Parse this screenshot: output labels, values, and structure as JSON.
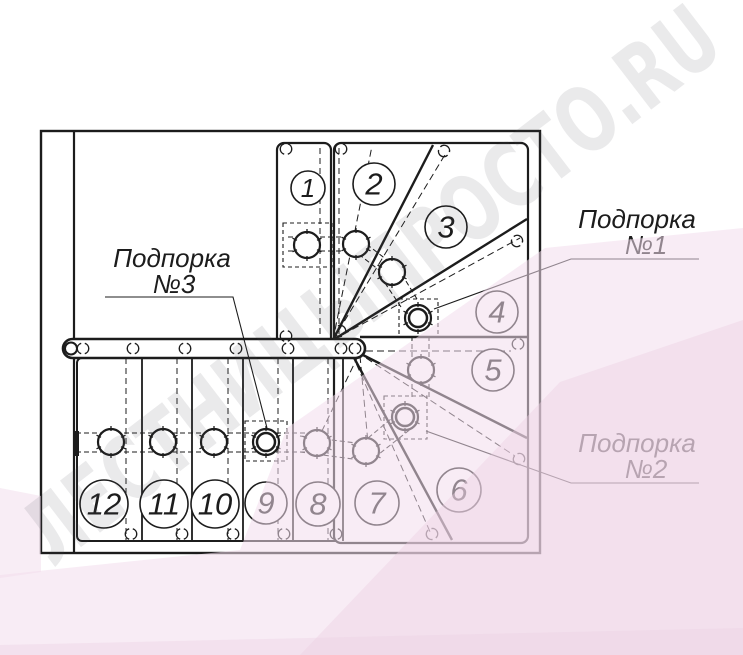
{
  "drawing": {
    "type": "staircase-plan",
    "steps": [
      "1",
      "2",
      "3",
      "4",
      "5",
      "6",
      "7",
      "8",
      "9",
      "10",
      "11",
      "12"
    ]
  },
  "supports": {
    "s1": {
      "line1": "Подпорка",
      "line2": "№1"
    },
    "s2": {
      "line1": "Подпорка",
      "line2": "№2"
    },
    "s3": {
      "line1": "Подпорка",
      "line2": "№3"
    }
  },
  "watermark": {
    "text": "ЛЕСТНИЦЫПРОСТО.RU",
    "gray": "#e9e9ec",
    "pink_light": "#f2dcec",
    "pink_deep": "#eccfe3"
  },
  "colors": {
    "ink": "#1c1c1c",
    "paper": "#ffffff"
  }
}
